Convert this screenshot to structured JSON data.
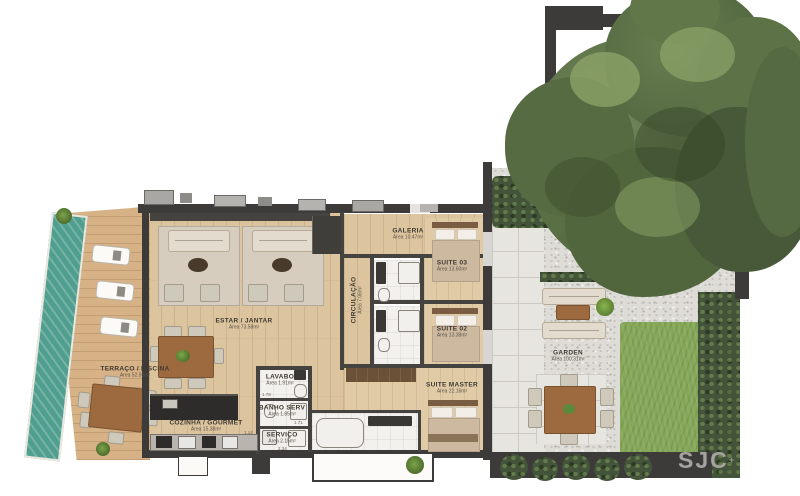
{
  "plan": {
    "rooms": [
      {
        "id": "terraco",
        "name": "TERRAÇO / PISCINA",
        "area": "Área 52.55m²"
      },
      {
        "id": "estar",
        "name": "ESTAR / JANTAR",
        "area": "Área 73.58m²"
      },
      {
        "id": "cozinha",
        "name": "COZINHA / GOURMET",
        "area": "Área 15.38m²"
      },
      {
        "id": "lavabo",
        "name": "LAVABO",
        "area": "Área 1.91m²"
      },
      {
        "id": "banho-serv",
        "name": "BANHO SERV",
        "area": "Área 1.85m²"
      },
      {
        "id": "servico",
        "name": "SERVIÇO",
        "area": "Área 2.15m²"
      },
      {
        "id": "circulacao",
        "name": "CIRCULAÇÃO",
        "area": "Área 7.06m²"
      },
      {
        "id": "galeria",
        "name": "GALERIA",
        "area": "Área 10.47m²"
      },
      {
        "id": "suite-03",
        "name": "SUITE 03",
        "area": "Área 13.60m²"
      },
      {
        "id": "suite-02",
        "name": "SUITE 02",
        "area": "Área 13.38m²"
      },
      {
        "id": "suite-master",
        "name": "SUITE MASTER",
        "area": "Área 22.16m²"
      },
      {
        "id": "garden",
        "name": "GARDEN",
        "area": "Área 100.31m²"
      }
    ],
    "dimensions": [
      "1.78",
      "1.71",
      "2.34",
      "1.14"
    ],
    "logo": {
      "text": "SJC",
      "mark": "+"
    }
  },
  "colors": {
    "pool": "#4f9e8e",
    "wood": "#dcc49e",
    "wall": "#3c3b39",
    "grass": "#85a758",
    "tree": "#5a7044",
    "gravel": "#dedcd7",
    "blanket": "#cdb99f"
  }
}
